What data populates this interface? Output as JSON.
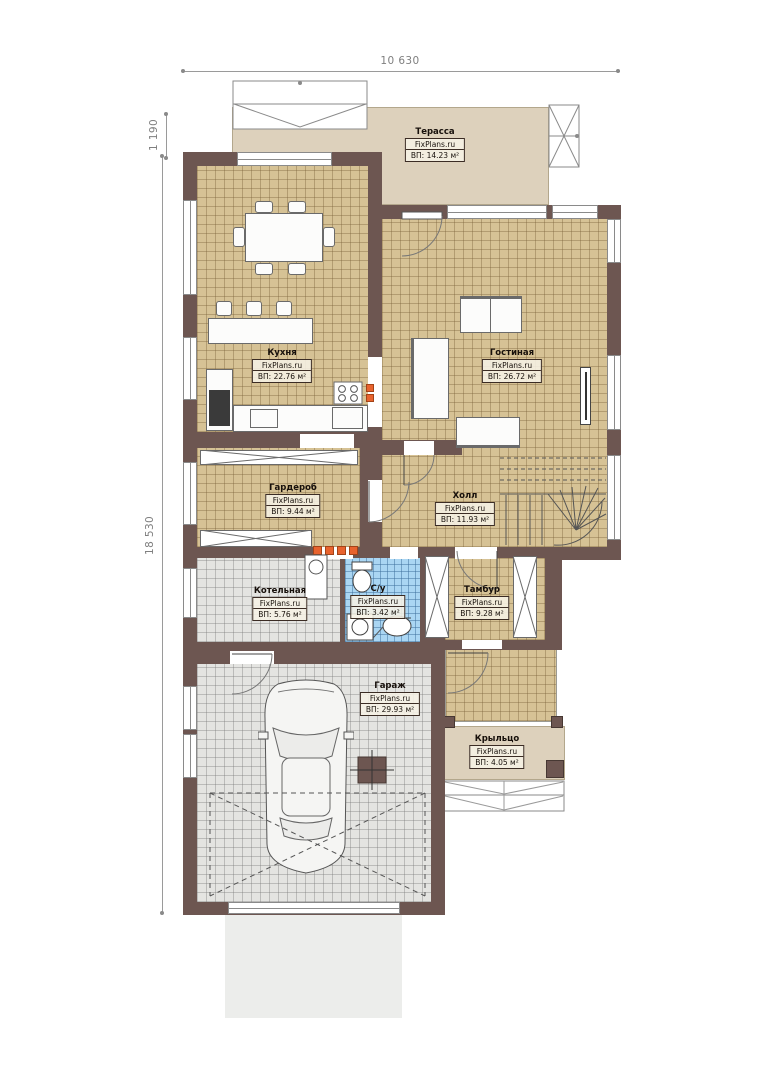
{
  "dims": {
    "top_width": "10 630",
    "left_offset": "1 190",
    "left_height": "18 530"
  },
  "branding": "FixPlans.ru",
  "rooms": {
    "terrace": {
      "name": "Терасса",
      "site": "FixPlans.ru",
      "area": "ВП: 14.23 м²"
    },
    "kitchen": {
      "name": "Кухня",
      "site": "FixPlans.ru",
      "area": "ВП: 22.76 м²"
    },
    "living": {
      "name": "Гостиная",
      "site": "FixPlans.ru",
      "area": "ВП: 26.72 м²"
    },
    "wardrobe": {
      "name": "Гардероб",
      "site": "FixPlans.ru",
      "area": "ВП: 9.44 м²"
    },
    "hall": {
      "name": "Холл",
      "site": "FixPlans.ru",
      "area": "ВП: 11.93 м²"
    },
    "boiler": {
      "name": "Котельная",
      "site": "FixPlans.ru",
      "area": "ВП: 5.76 м²"
    },
    "wc": {
      "name": "С/у",
      "site": "FixPlans.ru",
      "area": "ВП: 3.42 м²"
    },
    "tambour": {
      "name": "Тамбур",
      "site": "FixPlans.ru",
      "area": "ВП: 9.28 м²"
    },
    "garage": {
      "name": "Гараж",
      "site": "FixPlans.ru",
      "area": "ВП: 29.93 м²"
    },
    "porch": {
      "name": "Крыльцо",
      "site": "FixPlans.ru",
      "area": "ВП: 4.05 м²"
    }
  },
  "colors": {
    "wall": "#6d5651",
    "floor_beige": "#d6c295",
    "floor_grey": "#e4e4e1",
    "floor_blue": "#aad6f3",
    "terrace_beige": "#ddd1bc",
    "accent_orange": "#e8632e"
  }
}
